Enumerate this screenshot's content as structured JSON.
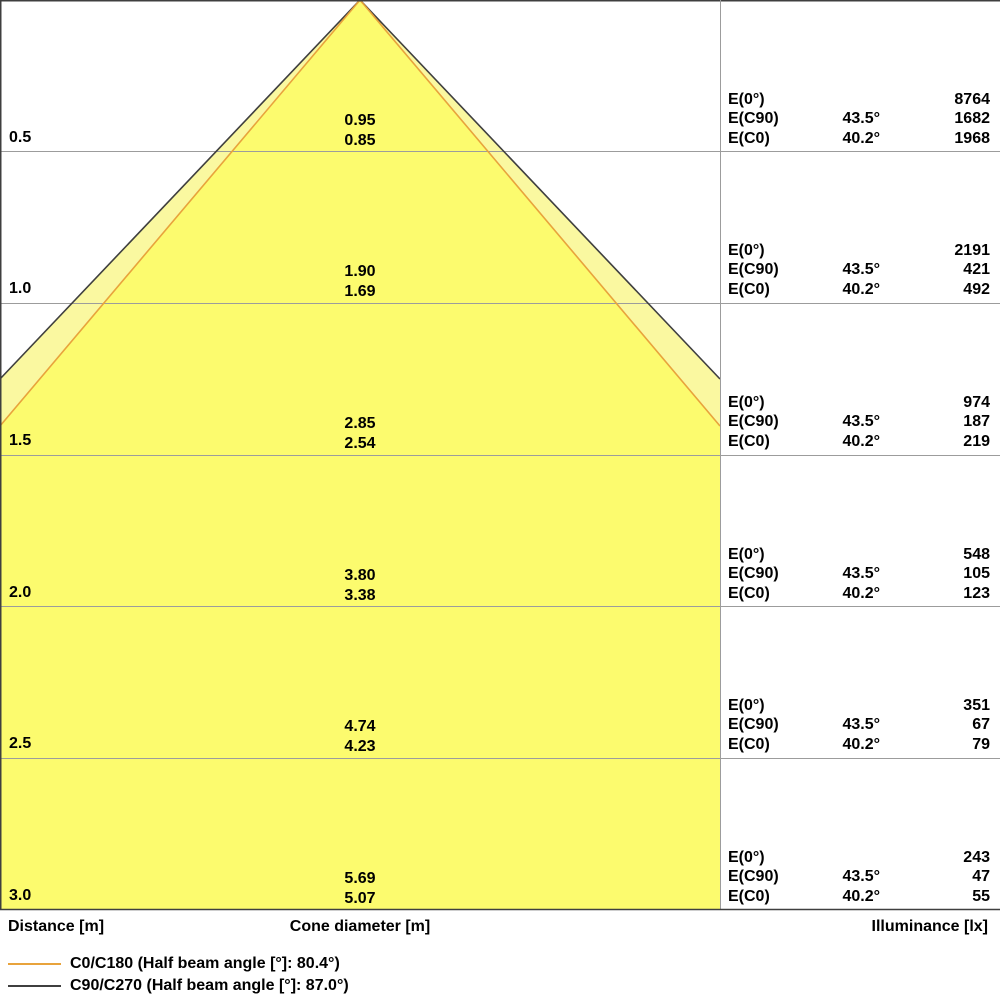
{
  "axes": {
    "distance_label": "Distance [m]",
    "cone_diameter_label": "Cone diameter [m]",
    "illuminance_label": "Illuminance [lx]"
  },
  "table": {
    "row_labels": [
      "E(0°)",
      "E(C90)",
      "E(C0)"
    ],
    "angle_c90": "43.5°",
    "angle_c0": "40.2°"
  },
  "rows": [
    {
      "distance": "0.5",
      "cone_c90": "0.95",
      "cone_c0": "0.85",
      "e0": "8764",
      "ec90": "1682",
      "ec0": "1968"
    },
    {
      "distance": "1.0",
      "cone_c90": "1.90",
      "cone_c0": "1.69",
      "e0": "2191",
      "ec90": "421",
      "ec0": "492"
    },
    {
      "distance": "1.5",
      "cone_c90": "2.85",
      "cone_c0": "2.54",
      "e0": "974",
      "ec90": "187",
      "ec0": "219"
    },
    {
      "distance": "2.0",
      "cone_c90": "3.80",
      "cone_c0": "3.38",
      "e0": "548",
      "ec90": "105",
      "ec0": "123"
    },
    {
      "distance": "2.5",
      "cone_c90": "4.74",
      "cone_c0": "4.23",
      "e0": "351",
      "ec90": "67",
      "ec0": "79"
    },
    {
      "distance": "3.0",
      "cone_c90": "5.69",
      "cone_c0": "5.07",
      "e0": "243",
      "ec90": "47",
      "ec0": "55"
    }
  ],
  "legend": [
    {
      "label": "C0/C180 (Half beam angle [°]: 80.4°)",
      "color": "#E8A33C"
    },
    {
      "label": "C90/C270 (Half beam angle [°]: 87.0°)",
      "color": "#3F3F3F"
    }
  ],
  "colors": {
    "inner_cone_fill": "#FCFB6E",
    "outer_cone_fill": "#FAF8A0",
    "c0_line": "#E8A33C",
    "c90_line": "#3F3F3F",
    "gridline": "#9C9C9C",
    "frame": "#3F3F3F"
  },
  "chart_data": {
    "type": "area",
    "subtype": "luminaire-light-cone-diagram",
    "xlabel": "Distance [m]",
    "ylabel_left": "Distance [m]",
    "value_label_center": "Cone diameter [m]",
    "value_label_right": "Illuminance [lx]",
    "distance_m": [
      0.5,
      1.0,
      1.5,
      2.0,
      2.5,
      3.0
    ],
    "series": [
      {
        "name": "C0/C180",
        "half_beam_angle_deg": 80.4,
        "half_angle_from_axis_deg": 40.2,
        "cone_diameter_m": [
          0.85,
          1.69,
          2.54,
          3.38,
          4.23,
          5.07
        ],
        "illuminance_lx": [
          1968,
          492,
          219,
          123,
          79,
          55
        ],
        "line_color": "#E8A33C",
        "fill_color": "#FCFB6E"
      },
      {
        "name": "C90/C270",
        "half_beam_angle_deg": 87.0,
        "half_angle_from_axis_deg": 43.5,
        "cone_diameter_m": [
          0.95,
          1.9,
          2.85,
          3.8,
          4.74,
          5.69
        ],
        "illuminance_lx": [
          1682,
          421,
          187,
          105,
          67,
          47
        ],
        "line_color": "#3F3F3F",
        "fill_color": "#FAF8A0"
      }
    ],
    "central_illuminance_E0_lx": [
      8764,
      2191,
      974,
      548,
      351,
      243
    ],
    "grid": true,
    "legend_position": "bottom-left",
    "apex_at_distance_m": 0
  }
}
